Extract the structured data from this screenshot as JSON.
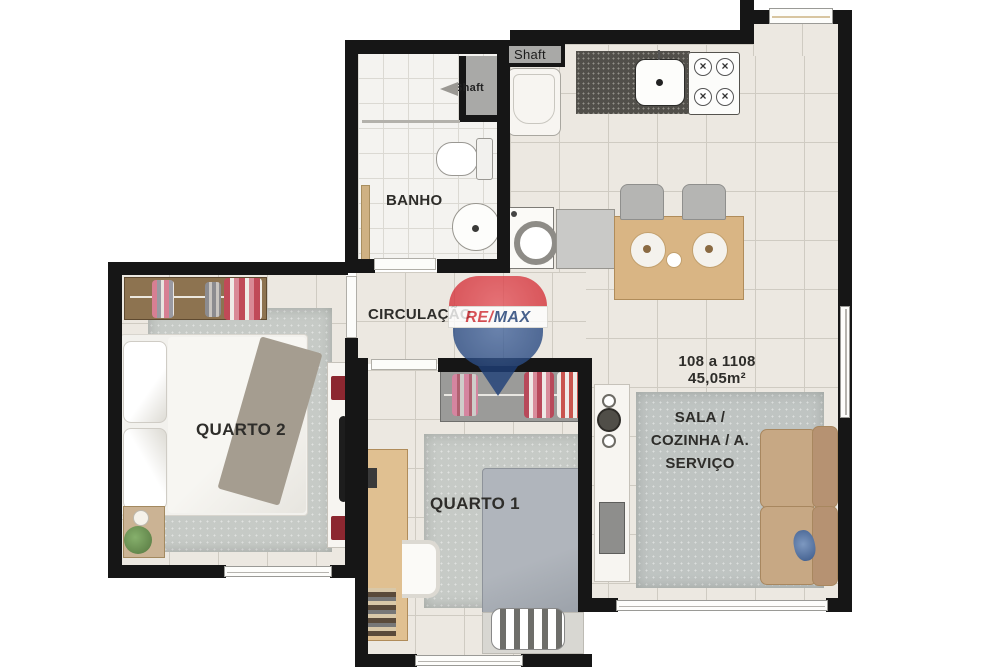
{
  "plan": {
    "watermark": {
      "part1": "RE",
      "slash": "/",
      "part2": "MAX"
    },
    "unit": {
      "range": "108 a 1108",
      "area": "45,05m²"
    },
    "rooms": {
      "quarto2": {
        "label": "QUARTO 2"
      },
      "quarto1": {
        "label": "QUARTO 1"
      },
      "banho": {
        "label": "BANHO"
      },
      "circulacao": {
        "label": "CIRCULAÇÃO"
      },
      "sala": {
        "lines": [
          "SALA /",
          "COZINHA / A.",
          "SERVIÇO"
        ]
      }
    },
    "shafts": {
      "bath": "Shaft",
      "kitchen": "Shaft"
    }
  },
  "theme": {
    "wall": "#161616",
    "floor": "#ece8e1",
    "grid": "#cfcbc2",
    "bath-floor": "#f4f3f0",
    "rug": "#c6cac6",
    "wood": "#d9b584",
    "sofa": "#c7a884",
    "remax-red": "#d22d35",
    "remax-blue": "#1e3f78"
  }
}
